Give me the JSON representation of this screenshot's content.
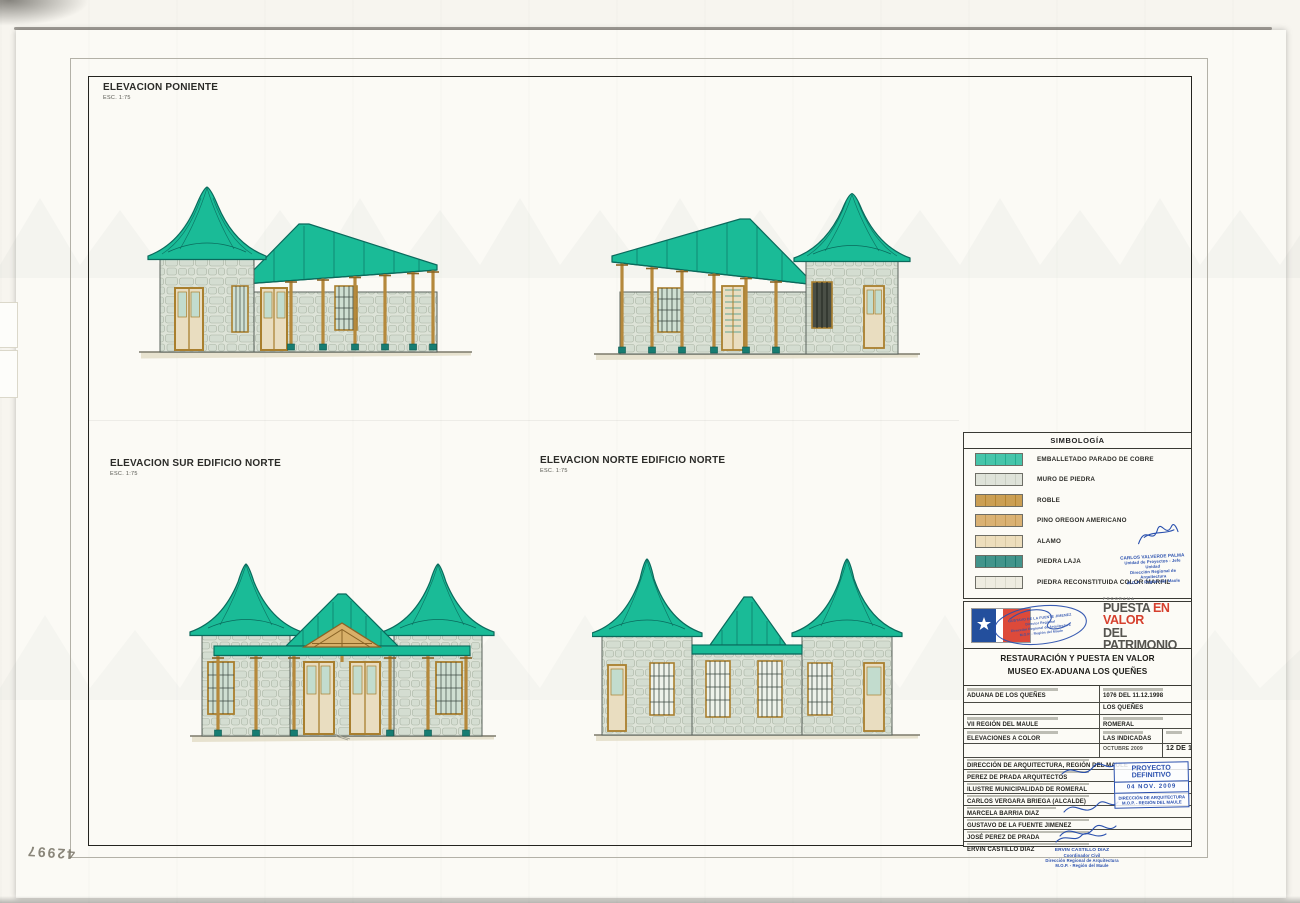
{
  "sheet": {
    "elevation_poniente": {
      "title": "ELEVACION PONIENTE",
      "scale": "ESC. 1:75"
    },
    "elevation_sur": {
      "title": "ELEVACION SUR EDIFICIO NORTE",
      "scale": "ESC. 1:75"
    },
    "elevation_norte": {
      "title": "ELEVACION NORTE EDIFICIO NORTE",
      "scale": "ESC. 1:75"
    },
    "handwritten_number": "42997"
  },
  "legend": {
    "title": "SIMBOLOGÍA",
    "items": [
      {
        "label": "EMBALLETADO PARADO DE COBRE",
        "color": "#1db897"
      },
      {
        "label": "MURO DE PIEDRA",
        "color": "#d8ddd1"
      },
      {
        "label": "ROBLE",
        "color": "#c08a2d"
      },
      {
        "label": "PINO OREGON AMERICANO",
        "color": "#d2a155"
      },
      {
        "label": "ALAMO",
        "color": "#e9d7ae"
      },
      {
        "label": "PIEDRA LAJA",
        "color": "#187d72"
      },
      {
        "label": "PIEDRA RECONSTITUIDA COLOR MARFIL",
        "color": "#eae8da"
      }
    ]
  },
  "titleblock": {
    "program_label": "PROGRAMA",
    "program_word1": "PUESTA",
    "program_word2": "EN VALOR",
    "program_word3": "DEL PATRIMONIO",
    "project_line1": "RESTAURACIÓN Y PUESTA EN VALOR",
    "project_line2": "MUSEO EX-ADUANA LOS QUEÑES",
    "monument": "ADUANA DE LOS QUEÑES",
    "decree": "1076 DEL 11.12.1998",
    "locality": "LOS QUEÑES",
    "region": "VII REGIÓN DEL MAULE",
    "comuna": "ROMERAL",
    "content": "ELEVACIONES A COLOR",
    "scale_value": "LAS INDICADAS",
    "date_value": "OCTUBRE 2009",
    "sheet_number": "12 DE 18",
    "rows": [
      "DIRECCIÓN DE ARQUITECTURA, REGIÓN DEL MAULE",
      "PEREZ DE PRADA ARQUITECTOS",
      "ILUSTRE MUNICIPALIDAD DE ROMERAL",
      "CARLOS VERGARA BRIEGA (ALCALDE)",
      "MARCELA BARRIA DIAZ",
      "GUSTAVO DE LA FUENTE JIMENEZ",
      "JOSÉ PEREZ DE PRADA",
      "ERVIN CASTILLO DIAZ"
    ]
  },
  "stamps": {
    "valverde": {
      "name": "CARLOS VALVERDE PALMA",
      "role": "Unidad de Proyectos - Jefe Unidad",
      "org": "Dirección Regional de Arquitectura",
      "region": "M.O.P. - Región del Maule"
    },
    "fuente": {
      "name": "GUSTAVO DE LA FUENTE JIMENEZ",
      "role": "Director Regional",
      "org": "Dirección Regional de Arquitectura",
      "region": "M.O.P. - Región del Maule"
    },
    "proyecto": {
      "title": "PROYECTO DEFINITIVO",
      "date": "04 NOV. 2009",
      "org": "DIRECCIÓN DE ARQUITECTURA",
      "region": "M.O.P. - REGIÓN DEL MAULE"
    },
    "castillo": {
      "name": "ERVIN CASTILLO DIAZ",
      "role": "Coordinador Civil",
      "org": "Dirección Regional de Arquitectura",
      "region": "M.O.P. - Región del Maule"
    }
  }
}
